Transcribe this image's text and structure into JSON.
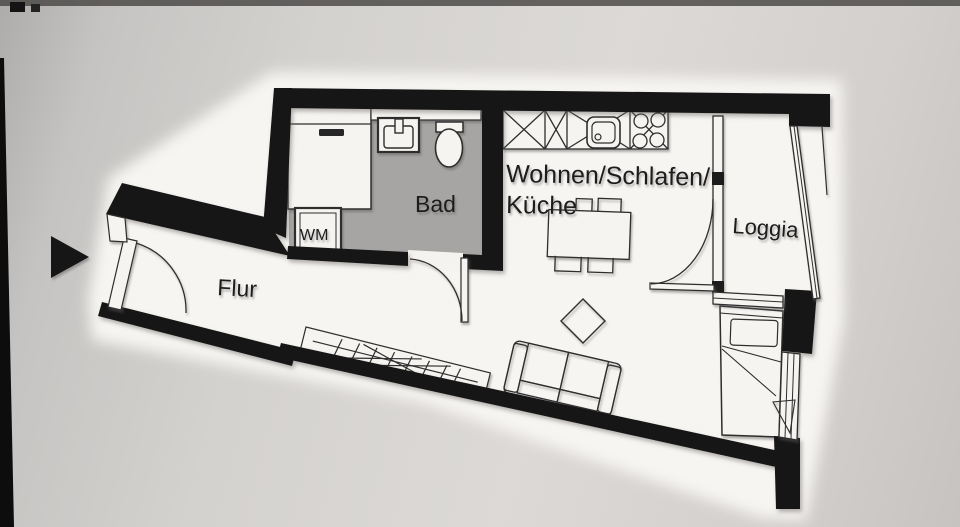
{
  "plan": {
    "rooms": {
      "living": {
        "label_line1": "Wohnen/Schlafen/",
        "label_line2": "Küche"
      },
      "bathroom": {
        "label": "Bad"
      },
      "hallway": {
        "label": "Flur"
      },
      "loggia": {
        "label": "Loggia"
      }
    },
    "appliances": {
      "washing_machine": {
        "label": "WM"
      }
    }
  },
  "colors": {
    "wall": "#161616",
    "bathroom_floor": "#a7a5a3",
    "paper": "#f5f3f0",
    "line": "#2e2e2e",
    "background_edge": "#aeacaa",
    "background_center": "#dcd9d6"
  }
}
